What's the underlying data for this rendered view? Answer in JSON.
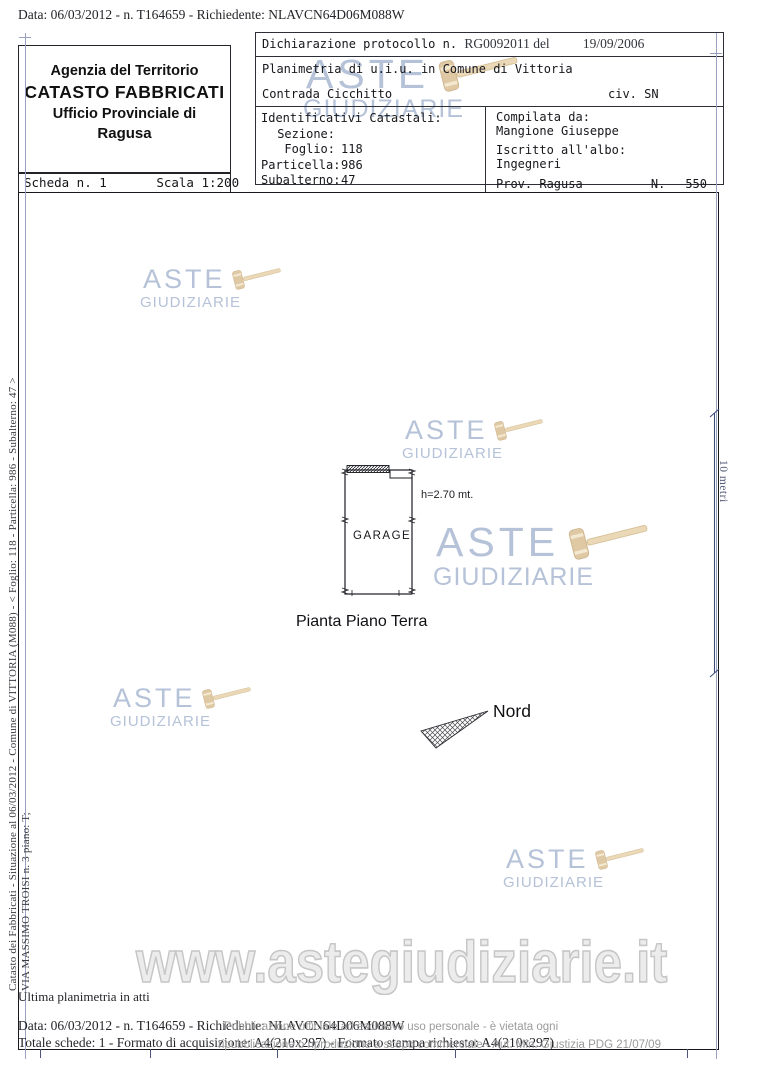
{
  "document": {
    "top_line": "Data: 06/03/2012 - n. T164659 - Richiedente: NLAVCN64D06M088W",
    "agency": {
      "line1": "Agenzia del Territorio",
      "line2": "CATASTO FABBRICATI",
      "line3": "Ufficio Provinciale di",
      "line4": "Ragusa"
    },
    "scheda_label": "Scheda n. 1",
    "scala_label": "Scala 1:200",
    "declaration": {
      "protocol_label": "Dichiarazione protocollo n.",
      "protocol_value": "RG0092011 del",
      "protocol_date": "19/09/2006",
      "planimetria_line": "Planimetria di u.i.u. in Comune di Vittoria",
      "address_line": "Contrada Cicchitto",
      "civic": "civ. SN"
    },
    "identificativi": {
      "title": "Identificativi Catastali:",
      "rows": [
        {
          "label": "Sezione:",
          "value": ""
        },
        {
          "label": "Foglio:",
          "value": "118"
        },
        {
          "label": "Particella:",
          "value": "986"
        },
        {
          "label": "Subalterno:",
          "value": "47"
        }
      ]
    },
    "compilata": {
      "title": "Compilata da:",
      "name": "Mangione Giuseppe",
      "albo_label": "Iscritto all'albo:",
      "albo_value": "Ingegneri",
      "prov": "Prov. Ragusa",
      "num_label": "N.",
      "num_value": "550"
    },
    "side_text": {
      "line1": "Catasto dei Fabbricati - Situazione al 06/03/2012 - Comune di VITTORIA (M088) - < Foglio: 118 - Particella: 986 - Subalterno: 47 >",
      "line2": "VIA MASSIMO TROISI n. 3 piano: T;"
    },
    "footer": {
      "ultima": "Ultima planimetria in atti",
      "data_line": "Data: 06/03/2012 - n. T164659 - Richiedente: NLAVCN64D06M088W",
      "totale_line": "Totale schede: 1 - Formato di acquisizione: A4(210x297) - Formato stampa richiesto: A4(210x297)"
    }
  },
  "plan": {
    "room_label": "GARAGE",
    "height_label": "h=2.70 mt.",
    "title": "Pianta Piano Terra",
    "north_label": "Nord",
    "scalebar_label": "10 metri"
  },
  "watermark": {
    "aste": "ASTE",
    "giudiziarie": "GIUDIZIARIE",
    "url": "www.astegiudiziarie.it",
    "disclaimer1": "Pubblicazione ufficiale ad esclusivo uso personale - è vietata ogni",
    "disclaimer2": "ripubblicazione o riproduzione a scopo commerciale - Aut. Min. Giustizia PDG 21/07/09",
    "colors": {
      "logo_text": "#b5c2d8",
      "gavel": "#dfc8a4",
      "url_outline": "#c6c6c6",
      "disclaimer": "#9b9b9b"
    }
  }
}
